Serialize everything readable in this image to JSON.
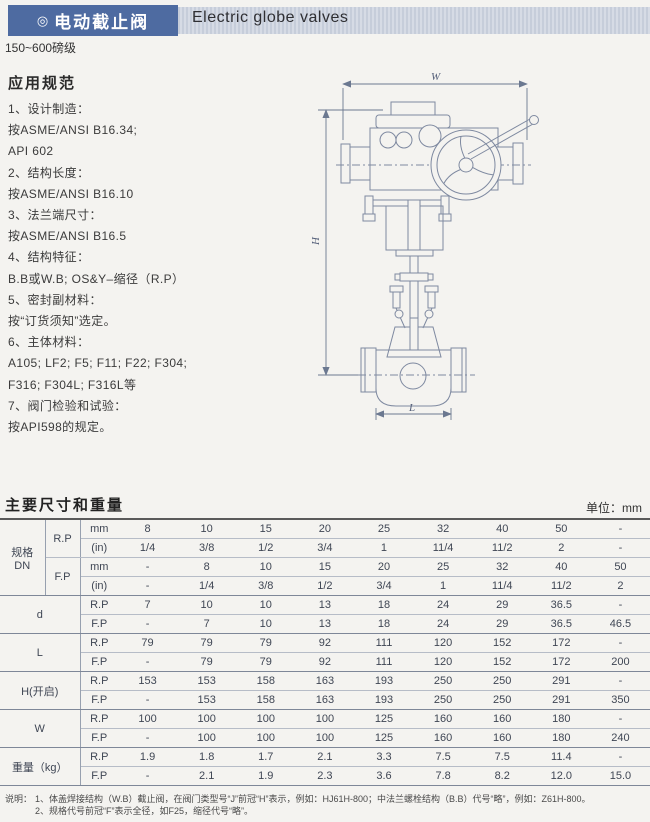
{
  "header": {
    "badge_icon": "◎",
    "title_cn": "电动截止阀",
    "title_en": "Electric globe valves",
    "pressure_class": "150~600磅级"
  },
  "specs": {
    "heading": "应用规范",
    "lines": [
      "1、设计制造：",
      "按ASME/ANSI B16.34;",
      "API 602",
      "2、结构长度：",
      "按ASME/ANSI B16.10",
      "3、法兰端尺寸：",
      "按ASME/ANSI B16.5",
      "4、结构特征：",
      "B.B或W.B; OS&Y–缩径（R.P）",
      "5、密封副材料：",
      "按“订货须知”选定。",
      "6、主体材料：",
      "A105;  LF2; F5; F11; F22; F304;",
      "F316; F304L; F316L等",
      "7、阀门检验和试验：",
      "按API598的规定。"
    ]
  },
  "drawing": {
    "labels": {
      "w": "W",
      "h": "H",
      "l": "L"
    }
  },
  "table": {
    "title": "主要尺寸和重量",
    "unit_label": "单位：mm",
    "groups": [
      {
        "label": "规格\nDN",
        "type": "dn",
        "subs": [
          {
            "label": "R.P",
            "rows": [
              {
                "label": "mm",
                "values": [
                  "8",
                  "10",
                  "15",
                  "20",
                  "25",
                  "32",
                  "40",
                  "50",
                  "-"
                ]
              },
              {
                "label": "(in)",
                "values": [
                  "1/4",
                  "3/8",
                  "1/2",
                  "3/4",
                  "1",
                  "11/4",
                  "11/2",
                  "2",
                  "-"
                ]
              }
            ]
          },
          {
            "label": "F.P",
            "rows": [
              {
                "label": "mm",
                "values": [
                  "-",
                  "8",
                  "10",
                  "15",
                  "20",
                  "25",
                  "32",
                  "40",
                  "50"
                ]
              },
              {
                "label": "(in)",
                "values": [
                  "-",
                  "1/4",
                  "3/8",
                  "1/2",
                  "3/4",
                  "1",
                  "11/4",
                  "11/2",
                  "2"
                ]
              }
            ]
          }
        ]
      },
      {
        "label": "d",
        "type": "simple",
        "rows": [
          {
            "label": "R.P",
            "values": [
              "7",
              "10",
              "10",
              "13",
              "18",
              "24",
              "29",
              "36.5",
              "-"
            ]
          },
          {
            "label": "F.P",
            "values": [
              "-",
              "7",
              "10",
              "13",
              "18",
              "24",
              "29",
              "36.5",
              "46.5"
            ]
          }
        ]
      },
      {
        "label": "L",
        "type": "simple",
        "rows": [
          {
            "label": "R.P",
            "values": [
              "79",
              "79",
              "79",
              "92",
              "111",
              "120",
              "152",
              "172",
              "-"
            ]
          },
          {
            "label": "F.P",
            "values": [
              "-",
              "79",
              "79",
              "92",
              "111",
              "120",
              "152",
              "172",
              "200"
            ]
          }
        ]
      },
      {
        "label": "H(开启)",
        "type": "simple",
        "rows": [
          {
            "label": "R.P",
            "values": [
              "153",
              "153",
              "158",
              "163",
              "193",
              "250",
              "250",
              "291",
              "-"
            ]
          },
          {
            "label": "F.P",
            "values": [
              "-",
              "153",
              "158",
              "163",
              "193",
              "250",
              "250",
              "291",
              "350"
            ]
          }
        ]
      },
      {
        "label": "W",
        "type": "simple",
        "rows": [
          {
            "label": "R.P",
            "values": [
              "100",
              "100",
              "100",
              "100",
              "125",
              "160",
              "160",
              "180",
              "-"
            ]
          },
          {
            "label": "F.P",
            "values": [
              "-",
              "100",
              "100",
              "100",
              "125",
              "160",
              "160",
              "180",
              "240"
            ]
          }
        ]
      },
      {
        "label": "重量（kg）",
        "type": "simple",
        "rows": [
          {
            "label": "R.P",
            "values": [
              "1.9",
              "1.8",
              "1.7",
              "2.1",
              "3.3",
              "7.5",
              "7.5",
              "11.4",
              "-"
            ]
          },
          {
            "label": "F.P",
            "values": [
              "-",
              "2.1",
              "1.9",
              "2.3",
              "3.6",
              "7.8",
              "8.2",
              "12.0",
              "15.0"
            ]
          }
        ]
      }
    ]
  },
  "notes": {
    "label": "说明：",
    "lines": [
      "1、体盖焊接结构（W.B）截止阀，在阀门类型号“J”前冠“H”表示，例如：HJ61H-800；中法兰螺栓结构（B.B）代号“略”，例如：Z61H-800。",
      "2、规格代号前冠“F”表示全径，如F25，缩径代号“略”。"
    ]
  }
}
